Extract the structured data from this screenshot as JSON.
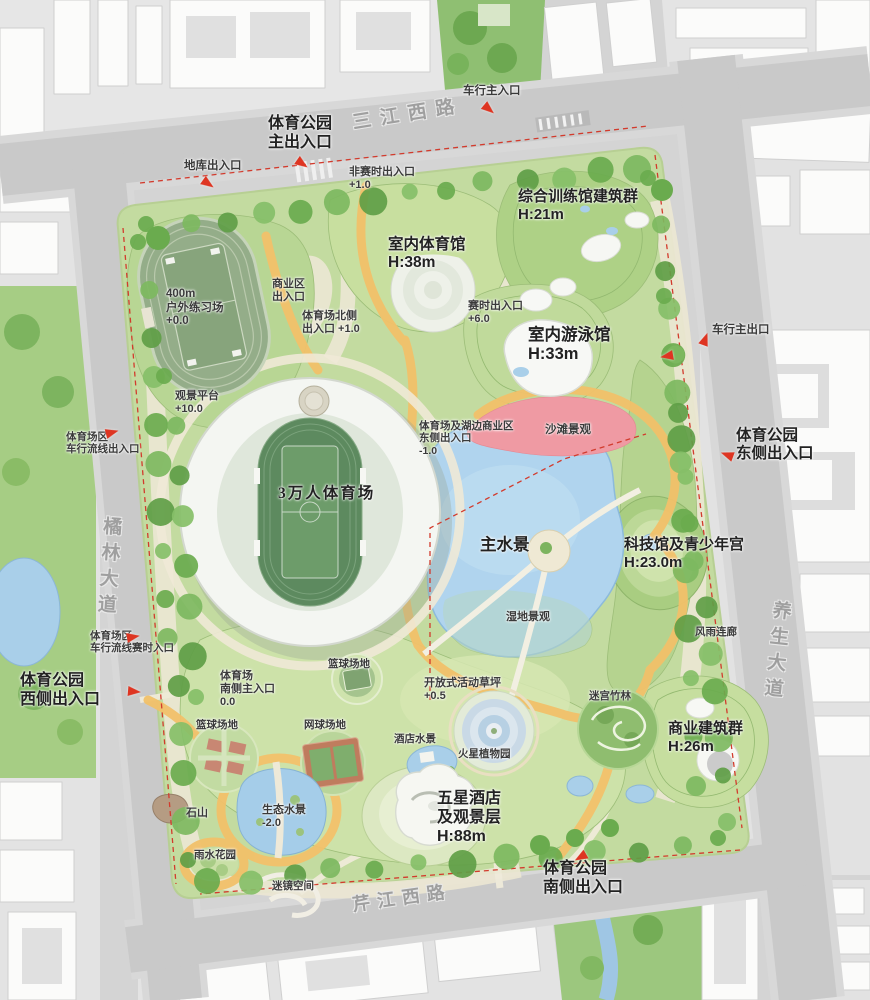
{
  "colors": {
    "road_gray": "#c9c9c9",
    "block_gray": "#e3e3e3",
    "building_white": "#fbfbfa",
    "park_green": "#c3dba0",
    "tree_green": "#6aab4e",
    "water_blue": "#b0d4ee",
    "path_yellow": "#f2c16a",
    "path_cream": "#ece7d3",
    "beach_pink": "#ef9aa3",
    "marker_red": "#de3522",
    "boundary_red_dashed": "#d23b2d"
  },
  "map_labels": [
    {
      "id": "road-sanjiang-west",
      "lines": [
        "三江西路"
      ],
      "x": 352,
      "y": 104,
      "size": 19,
      "cls": "road",
      "rotate": -9,
      "spacing": 9
    },
    {
      "id": "road-julin-avenue",
      "lines": [
        "橘林大道"
      ],
      "x": 96,
      "y": 516,
      "size": 19,
      "cls": "road vertical",
      "rotate": 4,
      "spacing": 7
    },
    {
      "id": "road-yangsheng-avenue",
      "lines": [
        "养生大道"
      ],
      "x": 764,
      "y": 600,
      "size": 19,
      "cls": "road vertical",
      "rotate": 6,
      "spacing": 7
    },
    {
      "id": "road-qinjiang-west",
      "lines": [
        "芹江西路"
      ],
      "x": 352,
      "y": 888,
      "size": 18,
      "cls": "road",
      "rotate": -8,
      "spacing": 7
    },
    {
      "id": "main-north-entrance",
      "lines": [
        "体育公园",
        "主出入口"
      ],
      "x": 300,
      "y": 115,
      "size": 16,
      "align": "center",
      "cls": "big"
    },
    {
      "id": "garage-entrance",
      "lines": [
        "地库出入口"
      ],
      "x": 184,
      "y": 160,
      "size": 11.5
    },
    {
      "id": "north-vehicle-entrance",
      "lines": [
        "车行主入口"
      ],
      "x": 463,
      "y": 85,
      "size": 11.5
    },
    {
      "id": "non-event-entrance",
      "lines": [
        "非赛时出入口",
        "+1.0"
      ],
      "x": 349,
      "y": 166,
      "size": 11
    },
    {
      "id": "training-complex",
      "lines": [
        "综合训练馆建筑群",
        "H:21m"
      ],
      "x": 518,
      "y": 188,
      "size": 15,
      "cls": "big"
    },
    {
      "id": "indoor-gymnasium",
      "lines": [
        "室内体育馆",
        "H:38m"
      ],
      "x": 388,
      "y": 236,
      "size": 15.5,
      "cls": "big"
    },
    {
      "id": "practice-field",
      "lines": [
        "400m",
        "户外练习场",
        "+0.0"
      ],
      "x": 166,
      "y": 288,
      "size": 11.5
    },
    {
      "id": "commercial-zone-entrance",
      "lines": [
        "商业区",
        "出入口"
      ],
      "x": 272,
      "y": 278,
      "size": 11
    },
    {
      "id": "stadium-north-entrance",
      "lines": [
        "体育场北侧",
        "出入口 +1.0"
      ],
      "x": 302,
      "y": 310,
      "size": 11
    },
    {
      "id": "event-time-entrance",
      "lines": [
        "赛时出入口",
        "+6.0"
      ],
      "x": 468,
      "y": 300,
      "size": 11
    },
    {
      "id": "indoor-swimming-hall",
      "lines": [
        "室内游泳馆",
        "H:33m"
      ],
      "x": 528,
      "y": 326,
      "size": 16.5,
      "cls": "big"
    },
    {
      "id": "east-vehicle-exit",
      "lines": [
        "车行主出口"
      ],
      "x": 712,
      "y": 324,
      "size": 11.5
    },
    {
      "id": "viewing-platform",
      "lines": [
        "观景平台",
        "+10.0"
      ],
      "x": 175,
      "y": 390,
      "size": 11
    },
    {
      "id": "stadium-lakeside-commercial-entrance",
      "lines": [
        "体育场及湖边商业区",
        "东侧出入口",
        "-1.0"
      ],
      "x": 419,
      "y": 420,
      "size": 10.5
    },
    {
      "id": "beach-landscape",
      "lines": [
        "沙滩景观"
      ],
      "x": 545,
      "y": 424,
      "size": 11.5
    },
    {
      "id": "east-entrance",
      "lines": [
        "体育公园",
        "东侧出入口"
      ],
      "x": 736,
      "y": 427,
      "size": 15.5,
      "cls": "big"
    },
    {
      "id": "nw-vehicle-circulation-entrance",
      "lines": [
        "体育场区",
        "车行流线出入口"
      ],
      "x": 66,
      "y": 431,
      "size": 10.5
    },
    {
      "id": "stadium-30k",
      "lines": [
        "3万人体育场"
      ],
      "x": 278,
      "y": 485,
      "size": 15.5,
      "serif": true,
      "cls": "big",
      "spacing": 2
    },
    {
      "id": "main-waterscape",
      "lines": [
        "主水景"
      ],
      "x": 480,
      "y": 536,
      "size": 16.5,
      "cls": "big"
    },
    {
      "id": "science-youth-palace",
      "lines": [
        "科技馆及青少年宫",
        "H:23.0m"
      ],
      "x": 624,
      "y": 536,
      "size": 15,
      "cls": "big"
    },
    {
      "id": "wetland-landscape",
      "lines": [
        "湿地景观"
      ],
      "x": 506,
      "y": 611,
      "size": 11
    },
    {
      "id": "rain-corridor",
      "lines": [
        "风雨连廊"
      ],
      "x": 695,
      "y": 626,
      "size": 10.5
    },
    {
      "id": "west-vehicle-event-entrance",
      "lines": [
        "体育场区",
        "车行流线赛时入口"
      ],
      "x": 90,
      "y": 630,
      "size": 10.5
    },
    {
      "id": "west-entrance",
      "lines": [
        "体育公园",
        "西侧出入口"
      ],
      "x": 20,
      "y": 672,
      "size": 16,
      "cls": "big"
    },
    {
      "id": "stadium-south-entrance",
      "lines": [
        "体育场",
        "南侧主入口",
        "0.0"
      ],
      "x": 220,
      "y": 670,
      "size": 11
    },
    {
      "id": "basketball-court-north",
      "lines": [
        "篮球场地"
      ],
      "x": 328,
      "y": 658,
      "size": 10.5
    },
    {
      "id": "open-activity-lawn",
      "lines": [
        "开放式活动草坪",
        "+0.5"
      ],
      "x": 424,
      "y": 677,
      "size": 11
    },
    {
      "id": "bamboo-maze",
      "lines": [
        "迷宫竹林"
      ],
      "x": 589,
      "y": 690,
      "size": 10.5
    },
    {
      "id": "basketball-court-west",
      "lines": [
        "篮球场地"
      ],
      "x": 196,
      "y": 719,
      "size": 10.5
    },
    {
      "id": "tennis-court",
      "lines": [
        "网球场地"
      ],
      "x": 304,
      "y": 719,
      "size": 10.5
    },
    {
      "id": "hotel-waterscape",
      "lines": [
        "酒店水景"
      ],
      "x": 394,
      "y": 733,
      "size": 10.5
    },
    {
      "id": "commercial-buildings",
      "lines": [
        "商业建筑群",
        "H:26m"
      ],
      "x": 668,
      "y": 720,
      "size": 15,
      "cls": "big"
    },
    {
      "id": "mars-botanical-garden",
      "lines": [
        "火星植物园"
      ],
      "x": 458,
      "y": 748,
      "size": 10.5
    },
    {
      "id": "five-star-hotel",
      "lines": [
        "五星酒店",
        "及观景层",
        "H:88m"
      ],
      "x": 437,
      "y": 790,
      "size": 16,
      "cls": "big"
    },
    {
      "id": "rock-hill",
      "lines": [
        "石山"
      ],
      "x": 186,
      "y": 807,
      "size": 11
    },
    {
      "id": "eco-waterscape",
      "lines": [
        "生态水景",
        "-2.0"
      ],
      "x": 262,
      "y": 804,
      "size": 11
    },
    {
      "id": "rain-garden",
      "lines": [
        "雨水花园"
      ],
      "x": 194,
      "y": 849,
      "size": 10.5
    },
    {
      "id": "mirror-maze-space",
      "lines": [
        "迷镜空间"
      ],
      "x": 272,
      "y": 880,
      "size": 10.5
    },
    {
      "id": "south-entrance",
      "lines": [
        "体育公园",
        "南侧出入口"
      ],
      "x": 543,
      "y": 860,
      "size": 16,
      "cls": "big"
    }
  ],
  "entrance_markers": [
    {
      "x": 297,
      "y": 155,
      "rot": 35
    },
    {
      "x": 203,
      "y": 175,
      "rot": 35
    },
    {
      "x": 484,
      "y": 100,
      "rot": 40
    },
    {
      "x": 703,
      "y": 340,
      "rot": -70
    },
    {
      "x": 673,
      "y": 350,
      "rot": 170
    },
    {
      "x": 733,
      "y": 452,
      "rot": 200
    },
    {
      "x": 106,
      "y": 429,
      "rot": -15
    },
    {
      "x": 127,
      "y": 633,
      "rot": -10
    },
    {
      "x": 128,
      "y": 686,
      "rot": 5
    },
    {
      "x": 586,
      "y": 849,
      "rot": 150
    }
  ]
}
